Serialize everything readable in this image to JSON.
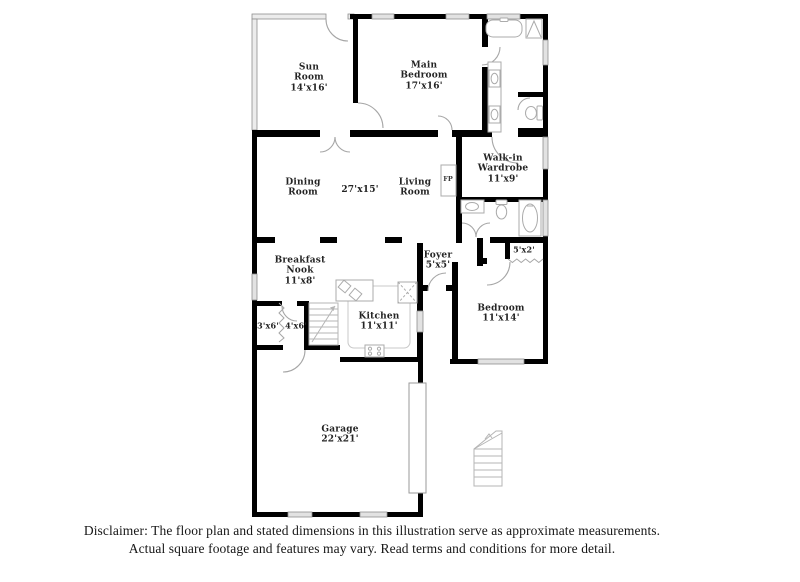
{
  "plan": {
    "rooms": [
      {
        "id": "sun-room",
        "lines": [
          "Sun",
          "Room",
          "14'x16'"
        ]
      },
      {
        "id": "main-bedroom",
        "lines": [
          "Main",
          "Bedroom",
          "17'x16'"
        ]
      },
      {
        "id": "walk-in-wardrobe",
        "lines": [
          "Walk-in",
          "Wardrobe",
          "11'x9'"
        ]
      },
      {
        "id": "dining-room",
        "lines": [
          "Dining",
          "Room"
        ]
      },
      {
        "id": "living-dining-dims",
        "lines": [
          "27'x15'"
        ]
      },
      {
        "id": "living-room",
        "lines": [
          "Living",
          "Room"
        ]
      },
      {
        "id": "fireplace",
        "lines": [
          "FP"
        ]
      },
      {
        "id": "breakfast-nook",
        "lines": [
          "Breakfast",
          "Nook",
          "11'x8'"
        ]
      },
      {
        "id": "foyer",
        "lines": [
          "Foyer",
          "5'x5'"
        ]
      },
      {
        "id": "closet-5x2",
        "lines": [
          "5'x2'"
        ]
      },
      {
        "id": "bedroom",
        "lines": [
          "Bedroom",
          "11'x14'"
        ]
      },
      {
        "id": "kitchen",
        "lines": [
          "Kitchen",
          "11'x11'"
        ]
      },
      {
        "id": "closet-3x6",
        "lines": [
          "3'x6'"
        ]
      },
      {
        "id": "closet-4x6",
        "lines": [
          "4'x6'"
        ]
      },
      {
        "id": "garage",
        "lines": [
          "Garage",
          "22'x21'"
        ]
      }
    ],
    "fixtures": [
      "bathtub",
      "shower",
      "double-vanity",
      "toilet",
      "sink",
      "shower-stall",
      "kitchen-island",
      "pantry",
      "stove",
      "staircase",
      "exterior-stairs",
      "fireplace-box",
      "garage-door",
      "accordion-door"
    ]
  },
  "colors": {
    "wall": "#000000",
    "window_fill": "#e2e2e2",
    "window_border": "#8f8f8f",
    "fixture_stroke": "#ababab",
    "door_arc": "#a6a6a6",
    "label_text": "#242424",
    "disclaimer_text": "#161616"
  },
  "disclaimer": {
    "line1": "Disclaimer: The floor plan and stated dimensions in this illustration serve as approximate measurements.",
    "line2": "Actual square footage and features may vary. Read terms and conditions for more detail."
  }
}
